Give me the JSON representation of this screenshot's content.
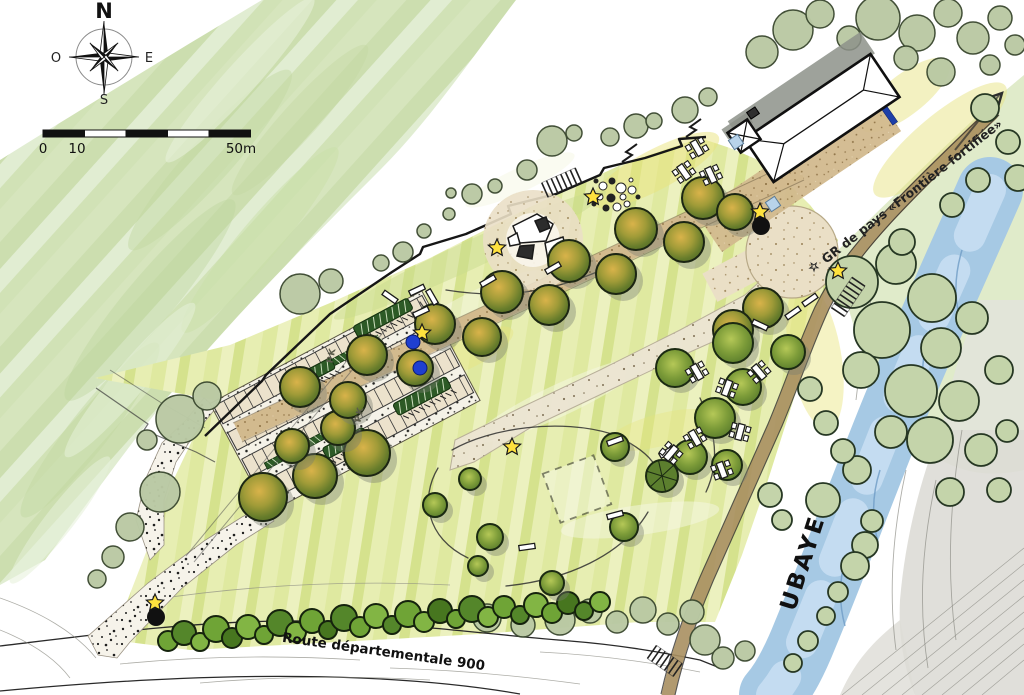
{
  "compass": {
    "north": "N",
    "west": "O",
    "east": "E",
    "south": "S"
  },
  "scale_bar": {
    "labels": [
      "0",
      "10",
      "50m"
    ],
    "segments": 5,
    "total_meters": 50
  },
  "labels": {
    "road": "Route départementale 900",
    "river": "UBAYE",
    "trail": "GR de pays «Frontière fortifiée»",
    "trail_marker": "☆",
    "parking1": "PK",
    "parking2": "PK"
  },
  "colors": {
    "star": "#ffe23e",
    "poi_dot": "#111111",
    "blue_dot": "#1f3fd0",
    "blue_bar": "#1d3fa8",
    "light_blue": "#b8d3ea",
    "river": "#a6c9e4",
    "trail_band": "#a88f60",
    "sand": "#d2ba8e",
    "sage": "#bac9a4",
    "hedge": "#2d5a26",
    "meadow": "#dfe9a0",
    "gravel": "#dddcd6"
  },
  "features": {
    "sage_trees": [
      [
        300,
        294,
        20
      ],
      [
        331,
        281,
        12
      ],
      [
        552,
        141,
        15
      ],
      [
        574,
        133,
        8
      ],
      [
        527,
        170,
        10
      ],
      [
        495,
        186,
        7
      ],
      [
        472,
        194,
        10
      ],
      [
        451,
        193,
        5
      ],
      [
        449,
        214,
        6
      ],
      [
        424,
        231,
        7
      ],
      [
        403,
        252,
        10
      ],
      [
        381,
        263,
        8
      ],
      [
        180,
        419,
        24
      ],
      [
        207,
        396,
        14
      ],
      [
        160,
        492,
        20
      ],
      [
        130,
        527,
        14
      ],
      [
        113,
        557,
        11
      ],
      [
        97,
        579,
        9
      ],
      [
        147,
        440,
        10
      ],
      [
        636,
        126,
        12
      ],
      [
        654,
        121,
        8
      ],
      [
        610,
        137,
        9
      ],
      [
        685,
        110,
        13
      ],
      [
        708,
        97,
        9
      ],
      [
        793,
        30,
        20
      ],
      [
        820,
        14,
        14
      ],
      [
        762,
        52,
        16
      ],
      [
        849,
        38,
        12
      ],
      [
        878,
        18,
        22
      ],
      [
        917,
        33,
        18
      ],
      [
        948,
        13,
        14
      ],
      [
        906,
        58,
        12
      ],
      [
        973,
        38,
        16
      ],
      [
        1000,
        18,
        12
      ],
      [
        941,
        72,
        14
      ],
      [
        990,
        65,
        10
      ],
      [
        1015,
        45,
        10
      ],
      [
        487,
        618,
        14
      ],
      [
        523,
        625,
        12
      ],
      [
        560,
        620,
        15
      ],
      [
        590,
        611,
        12
      ],
      [
        617,
        622,
        11
      ],
      [
        643,
        610,
        13
      ],
      [
        668,
        624,
        11
      ],
      [
        692,
        612,
        12
      ],
      [
        705,
        640,
        15
      ],
      [
        723,
        658,
        11
      ],
      [
        745,
        651,
        10
      ]
    ],
    "riparian_trees": [
      [
        852,
        282,
        26
      ],
      [
        896,
        264,
        20
      ],
      [
        932,
        298,
        24
      ],
      [
        882,
        330,
        28
      ],
      [
        941,
        348,
        20
      ],
      [
        972,
        318,
        16
      ],
      [
        911,
        391,
        26
      ],
      [
        959,
        401,
        20
      ],
      [
        861,
        370,
        18
      ],
      [
        999,
        370,
        14
      ],
      [
        930,
        440,
        23
      ],
      [
        981,
        450,
        16
      ],
      [
        891,
        432,
        16
      ],
      [
        857,
        470,
        14
      ],
      [
        823,
        500,
        17
      ],
      [
        950,
        492,
        14
      ],
      [
        1007,
        431,
        11
      ],
      [
        872,
        521,
        11
      ],
      [
        843,
        451,
        12
      ],
      [
        826,
        423,
        12
      ],
      [
        810,
        389,
        12
      ],
      [
        999,
        490,
        12
      ],
      [
        865,
        545,
        13
      ],
      [
        855,
        566,
        14
      ],
      [
        838,
        592,
        10
      ],
      [
        826,
        616,
        9
      ],
      [
        808,
        641,
        10
      ],
      [
        793,
        663,
        9
      ],
      [
        770,
        495,
        12
      ],
      [
        782,
        520,
        10
      ],
      [
        985,
        108,
        14
      ],
      [
        1008,
        142,
        12
      ],
      [
        1018,
        178,
        13
      ],
      [
        978,
        180,
        12
      ],
      [
        952,
        205,
        12
      ],
      [
        902,
        242,
        13
      ]
    ],
    "olive_trees": [
      [
        263,
        497,
        24
      ],
      [
        315,
        476,
        22
      ],
      [
        367,
        453,
        23
      ],
      [
        292,
        446,
        17
      ],
      [
        338,
        428,
        17
      ],
      [
        300,
        387,
        20
      ],
      [
        367,
        355,
        20
      ],
      [
        435,
        324,
        20
      ],
      [
        502,
        292,
        21
      ],
      [
        569,
        261,
        21
      ],
      [
        636,
        229,
        21
      ],
      [
        703,
        198,
        21
      ],
      [
        348,
        400,
        18
      ],
      [
        415,
        368,
        18
      ],
      [
        482,
        337,
        19
      ],
      [
        549,
        305,
        20
      ],
      [
        616,
        274,
        20
      ],
      [
        684,
        242,
        20
      ],
      [
        763,
        308,
        20
      ],
      [
        733,
        330,
        20
      ],
      [
        735,
        212,
        18
      ]
    ],
    "meadow_trees": [
      [
        615,
        447,
        14
      ],
      [
        624,
        527,
        14
      ],
      [
        490,
        537,
        13
      ],
      [
        470,
        479,
        11
      ],
      [
        435,
        505,
        12
      ],
      [
        552,
        583,
        12
      ],
      [
        478,
        566,
        10
      ],
      [
        675,
        368,
        19
      ],
      [
        733,
        343,
        20
      ],
      [
        788,
        352,
        17
      ],
      [
        743,
        387,
        18
      ],
      [
        715,
        418,
        20
      ],
      [
        690,
        457,
        17
      ],
      [
        727,
        465,
        15
      ]
    ],
    "spoke_tree": [
      662,
      476,
      16
    ],
    "shrubs": [
      [
        168,
        641,
        10,
        0
      ],
      [
        184,
        633,
        12,
        1
      ],
      [
        200,
        642,
        9,
        2
      ],
      [
        216,
        629,
        13,
        0
      ],
      [
        232,
        638,
        10,
        3
      ],
      [
        248,
        627,
        12,
        2
      ],
      [
        264,
        635,
        9,
        0
      ],
      [
        280,
        623,
        13,
        1
      ],
      [
        296,
        632,
        10,
        2
      ],
      [
        312,
        621,
        12,
        0
      ],
      [
        328,
        630,
        9,
        3
      ],
      [
        344,
        618,
        13,
        1
      ],
      [
        360,
        627,
        10,
        0
      ],
      [
        376,
        616,
        12,
        2
      ],
      [
        392,
        625,
        9,
        1
      ],
      [
        408,
        614,
        13,
        0
      ],
      [
        424,
        622,
        10,
        2
      ],
      [
        440,
        611,
        12,
        3
      ],
      [
        456,
        619,
        9,
        0
      ],
      [
        472,
        609,
        13,
        1
      ],
      [
        488,
        617,
        10,
        2
      ],
      [
        504,
        607,
        11,
        0
      ],
      [
        520,
        615,
        9,
        1
      ],
      [
        536,
        605,
        12,
        2
      ],
      [
        552,
        613,
        10,
        0
      ],
      [
        568,
        603,
        11,
        3
      ],
      [
        584,
        611,
        9,
        1
      ],
      [
        600,
        602,
        10,
        2
      ]
    ],
    "stars": [
      [
        155,
        603
      ],
      [
        422,
        333
      ],
      [
        497,
        248
      ],
      [
        512,
        447
      ],
      [
        593,
        197
      ],
      [
        760,
        212
      ],
      [
        838,
        271
      ]
    ],
    "black_dots": [
      [
        156,
        617
      ],
      [
        761,
        226
      ]
    ],
    "blue_dots": [
      [
        413,
        342
      ],
      [
        420,
        368
      ]
    ],
    "blue_squares": [
      [
        736,
        142
      ],
      [
        773,
        204
      ]
    ],
    "blue_bar": [
      890,
      116,
      55
    ],
    "picnic_tables": [
      [
        697,
        148,
        -30
      ],
      [
        684,
        172,
        -35
      ],
      [
        711,
        175,
        -25
      ],
      [
        697,
        372,
        -30
      ],
      [
        727,
        388,
        20
      ],
      [
        759,
        372,
        -40
      ],
      [
        740,
        432,
        15
      ],
      [
        695,
        438,
        -30
      ],
      [
        722,
        470,
        -20
      ],
      [
        671,
        453,
        40
      ]
    ],
    "benches": [
      [
        417,
        290,
        -25
      ],
      [
        432,
        297,
        60
      ],
      [
        421,
        312,
        -25
      ],
      [
        390,
        297,
        35
      ],
      [
        488,
        281,
        -30
      ],
      [
        615,
        441,
        -20
      ],
      [
        667,
        452,
        -30
      ],
      [
        615,
        515,
        -15
      ],
      [
        527,
        547,
        -8
      ],
      [
        760,
        325,
        25
      ],
      [
        793,
        313,
        -35
      ],
      [
        810,
        300,
        -35
      ],
      [
        553,
        268,
        -30
      ]
    ],
    "hedges": [
      [
        383,
        318,
        62,
        13,
        62
      ],
      [
        310,
        375,
        52,
        12,
        62
      ],
      [
        422,
        396,
        60,
        13,
        62
      ],
      [
        345,
        443,
        46,
        12,
        62
      ]
    ],
    "steps": [
      [
        545,
        190,
        -24,
        8
      ],
      [
        838,
        312,
        -56,
        8
      ],
      [
        652,
        652,
        35,
        7
      ]
    ],
    "boulder_field": [
      [
        603,
        186,
        4,
        0
      ],
      [
        612,
        181,
        3,
        1
      ],
      [
        621,
        188,
        5,
        0
      ],
      [
        600,
        197,
        3,
        0
      ],
      [
        611,
        198,
        4,
        1
      ],
      [
        623,
        197,
        3,
        0
      ],
      [
        632,
        190,
        4,
        0
      ],
      [
        606,
        208,
        3,
        1
      ],
      [
        617,
        207,
        4,
        0
      ],
      [
        627,
        204,
        3,
        0
      ],
      [
        596,
        181,
        2,
        1
      ],
      [
        631,
        180,
        2,
        0
      ],
      [
        638,
        197,
        2,
        1
      ],
      [
        594,
        204,
        2,
        1
      ]
    ],
    "mound": {
      "cx": 533,
      "cy": 240,
      "r": 50
    },
    "boulders": [
      {
        "pts": "513,226 537,214 553,224 546,241 520,243",
        "dark": 0
      },
      {
        "pts": "545,243 563,237 567,254 548,260",
        "dark": 0
      },
      {
        "pts": "520,246 534,245 532,259 517,256",
        "dark": 1
      },
      {
        "pts": "535,221 546,217 550,228 540,232",
        "dark": 1
      },
      {
        "pts": "508,238 517,233 520,244 510,246",
        "dark": 0
      }
    ],
    "dashed_square": {
      "cx": 577,
      "cy": 489,
      "size": 54,
      "rot": -20
    },
    "zigzags": [
      [
        622,
        162
      ],
      [
        686,
        137
      ]
    ]
  }
}
